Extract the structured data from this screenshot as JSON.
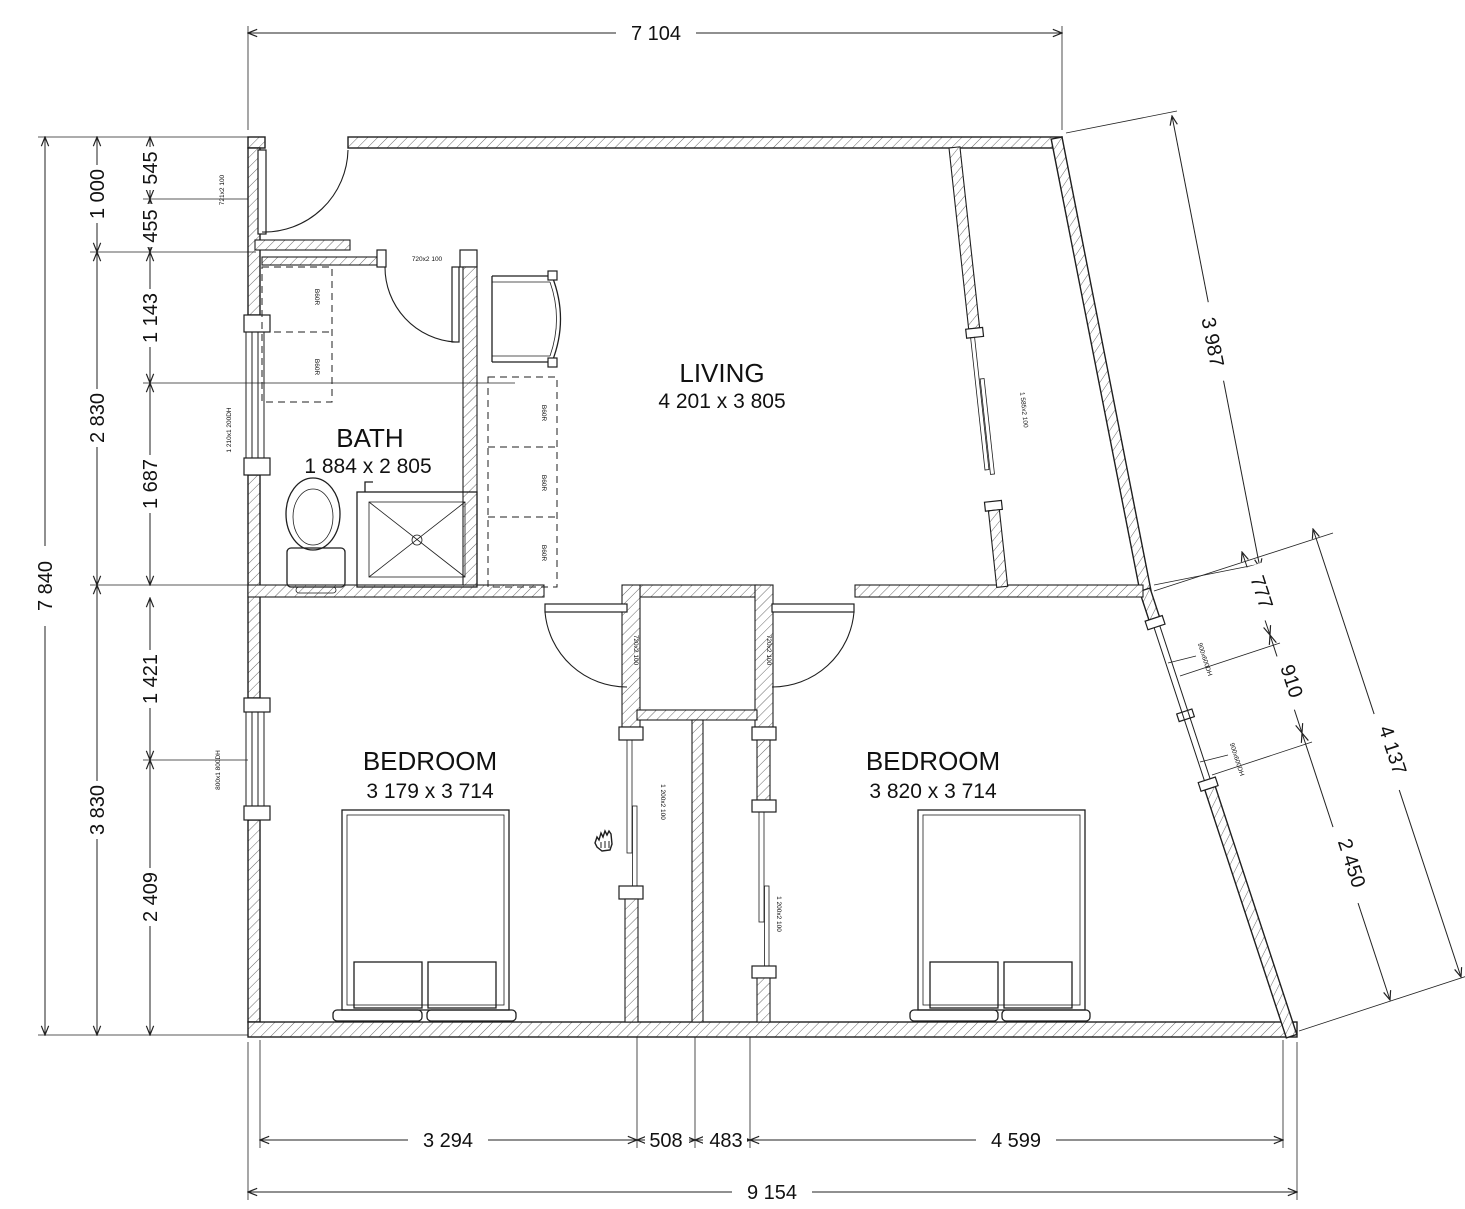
{
  "rooms": {
    "living": {
      "name": "LIVING",
      "size": "4 201 x 3 805"
    },
    "bath": {
      "name": "BATH",
      "size": "1 884 x 2 805"
    },
    "bedroom1": {
      "name": "BEDROOM",
      "size": "3 179 x 3 714"
    },
    "bedroom2": {
      "name": "BEDROOM",
      "size": "3 820 x 3 714"
    }
  },
  "dims": {
    "top_width": "7 104",
    "left_total": "7 840",
    "left_1000": "1 000",
    "left_2830": "2 830",
    "left_3830": "3 830",
    "left_545": "545",
    "left_455": "455",
    "left_1143": "1 143",
    "left_1687": "1 687",
    "left_1421": "1 421",
    "left_2409": "2 409",
    "slant_3987": "3 987",
    "slant_777": "777",
    "slant_910": "910",
    "slant_4137": "4 137",
    "slant_2450": "2 450",
    "bottom_3294": "3 294",
    "bottom_508": "508",
    "bottom_483": "483",
    "bottom_4599": "4 599",
    "bottom_total": "9 154"
  },
  "tags": {
    "entry_door": "721x2 100",
    "bath_door": "720x2 100",
    "bed1_door": "720x2 100",
    "bed2_door": "720x2 100",
    "robe1_slider": "1 200x2 100",
    "robe2_slider": "1 200x2 100",
    "living_slider": "1 585x2 100",
    "bath_window": "1 210x1 200DH",
    "bed1_window": "800x1 800DH",
    "slant_window_top": "900x600DH",
    "slant_window_bottom": "900x600DH",
    "cab_bath_1": "B60R",
    "cab_bath_2": "B60R",
    "cab_living_1": "B60R",
    "cab_living_2": "B60R",
    "cab_living_3": "B60R"
  },
  "colors": {
    "line": "#1f1f1f",
    "background": "#ffffff"
  }
}
